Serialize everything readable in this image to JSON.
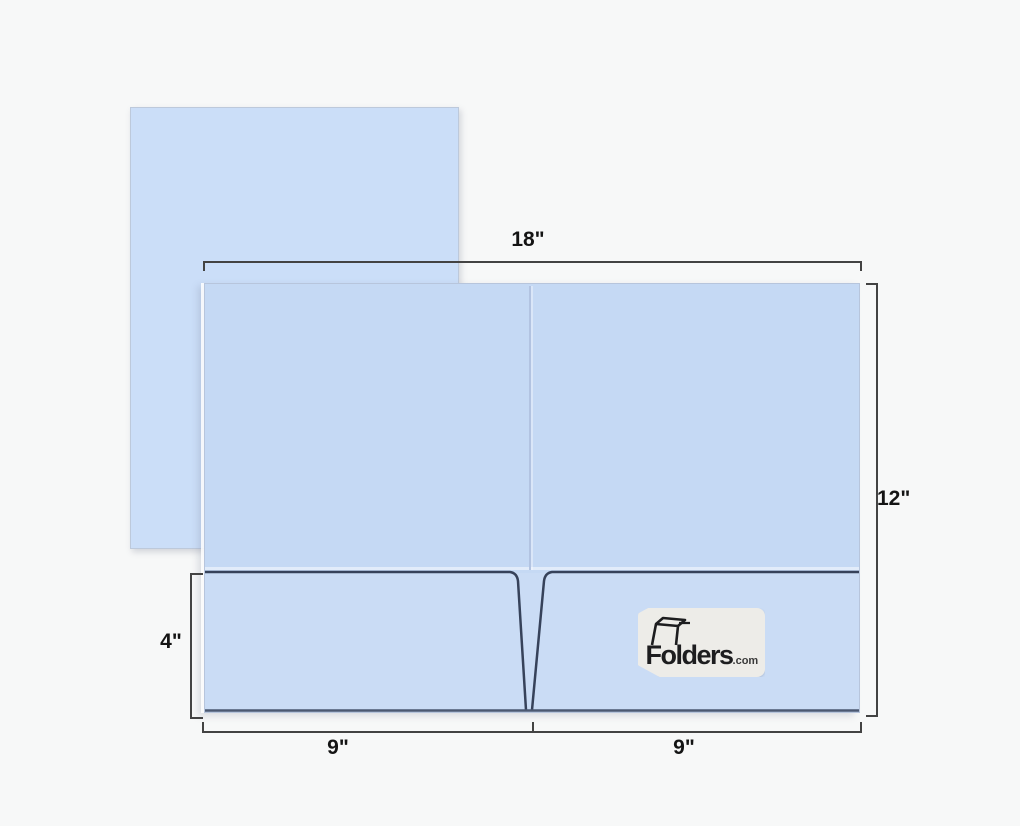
{
  "image": {
    "background_color": "#f7f8f8",
    "description_names": {
      "sheet": "letter-paper-behind-folder",
      "folder": "open-two-pocket-presentation-folder"
    }
  },
  "folder": {
    "sheet_color": "#cbdef8",
    "panel_color": "#c5d9f4",
    "pocket_edge_color": "#36425a",
    "logo": {
      "brand": "Folders",
      "suffix": ".com"
    }
  },
  "dimensions": {
    "line_color": "#434343",
    "text_color": "#141414",
    "total_width": "18\"",
    "total_height": "12\"",
    "pocket_height": "4\"",
    "left_panel_width": "9\"",
    "right_panel_width": "9\""
  }
}
